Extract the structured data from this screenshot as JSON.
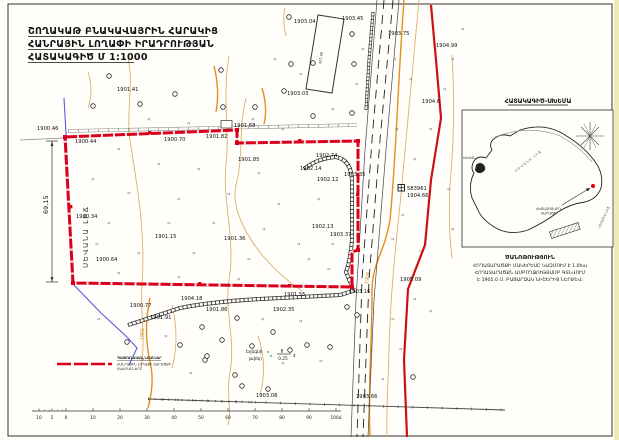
{
  "title": {
    "line1": "ՇՈՂԱԿԱԹ ԲՆԱԿԱՎԱՅՐԻՆ ՀԱՐԱԿԻՑ",
    "line2": "ՀԱՆՐԱՅԻՆ ԼՈՂԱՓԻ ԻՐԱԴՐՈՒԹՅԱՆ",
    "line3": "ՀԱՏԱԿԱԳԻԾ Մ 1:1000"
  },
  "colors": {
    "boundary_red": "#d9001c",
    "road_red": "#cc1111",
    "contour_minor": "#d8b06a",
    "contour_major": "#e2901a",
    "water_blue": "#5b5bd6"
  },
  "map": {
    "elevations": [
      "1903.04",
      "1903.45",
      "1903.75",
      "1904.99",
      "1901.41",
      "1903.03",
      "1904.6",
      "1900.46",
      "1900.44",
      "1901.68",
      "1900.70",
      "1901.82",
      "1901.85",
      "1902.74",
      "1902.14",
      "1902.12",
      "1903.35",
      "1902.13",
      "1903.37",
      "1900.34",
      "1901.15",
      "1901.36",
      "1900.64",
      "1900.77",
      "1901.91",
      "1904.18",
      "1901.86",
      "1902.35",
      "1901.55",
      "1903.16",
      "1905.09",
      "1903.66",
      "1903.08"
    ],
    "benchmark": {
      "id": "583961",
      "elevation": "1904.66"
    },
    "contour_labels": {
      "major": "1904",
      "minor": "1902"
    },
    "lake_label": "ՍԵՎԱՆԱ ԼԻՃ",
    "dimension": "69,15",
    "building_label": "427.48",
    "reed": {
      "line1": "եղեգնի",
      "line2": "թփեր",
      "frac_top": "8",
      "frac_bottom": "0.25",
      "right": "4"
    }
  },
  "inset": {
    "title": "ՀԱՏԱԿԱԳԻԾ-ՍԽԵՄԱ",
    "lake_label": "ՍԵՎԱՆԱ ԼԻՃ",
    "town_label": "ՍԵՎԱՆ",
    "area_label_1": "ՀԵՏԱԶՈՏՎՈՂ",
    "area_label_2": "ՏԱՐԱԾՔ",
    "corner_label": "ՍԵՎԱՆԱ ԼԻՃ"
  },
  "note": {
    "title": "ԾԱՆՈԹՈՒԹՅՈՒՆ",
    "line1": "ՀՈՂԱՏԱՐԱԾՔԻ ՄԱԿԵՐԵՍԸ ԿԱԶՄՈՒՄ Է 1.0հա",
    "line2": "ՀՈՂԱՏԱՐԱԾՔՆ ԱՄԲՈՂՋՈՒԹՅԱՄԲ ԳՏՆՎՈՒՄ",
    "line3": "Է 1905.0 Մ. ԲԱՑԱՐՁԱԿ ՆԻՇԵՐԻՑ ՆԵՐՔԵՎ:"
  },
  "legend": {
    "title": "ՊԱՅՄԱՆԱԿԱՆ ՆՇԱՆՆԵՐ",
    "line1": "ՀԱՆՐԱՅԻՆ ԼՈՂԱՓԻ ՏԱՐԱԾՔԻ",
    "line2": "ՍԱՀՄԱՆՆԵՐԸ"
  },
  "scalebar": {
    "labels": [
      "10",
      "5",
      "0",
      "10",
      "20",
      "30",
      "40",
      "50",
      "60",
      "70",
      "80",
      "90",
      "100մ"
    ]
  }
}
